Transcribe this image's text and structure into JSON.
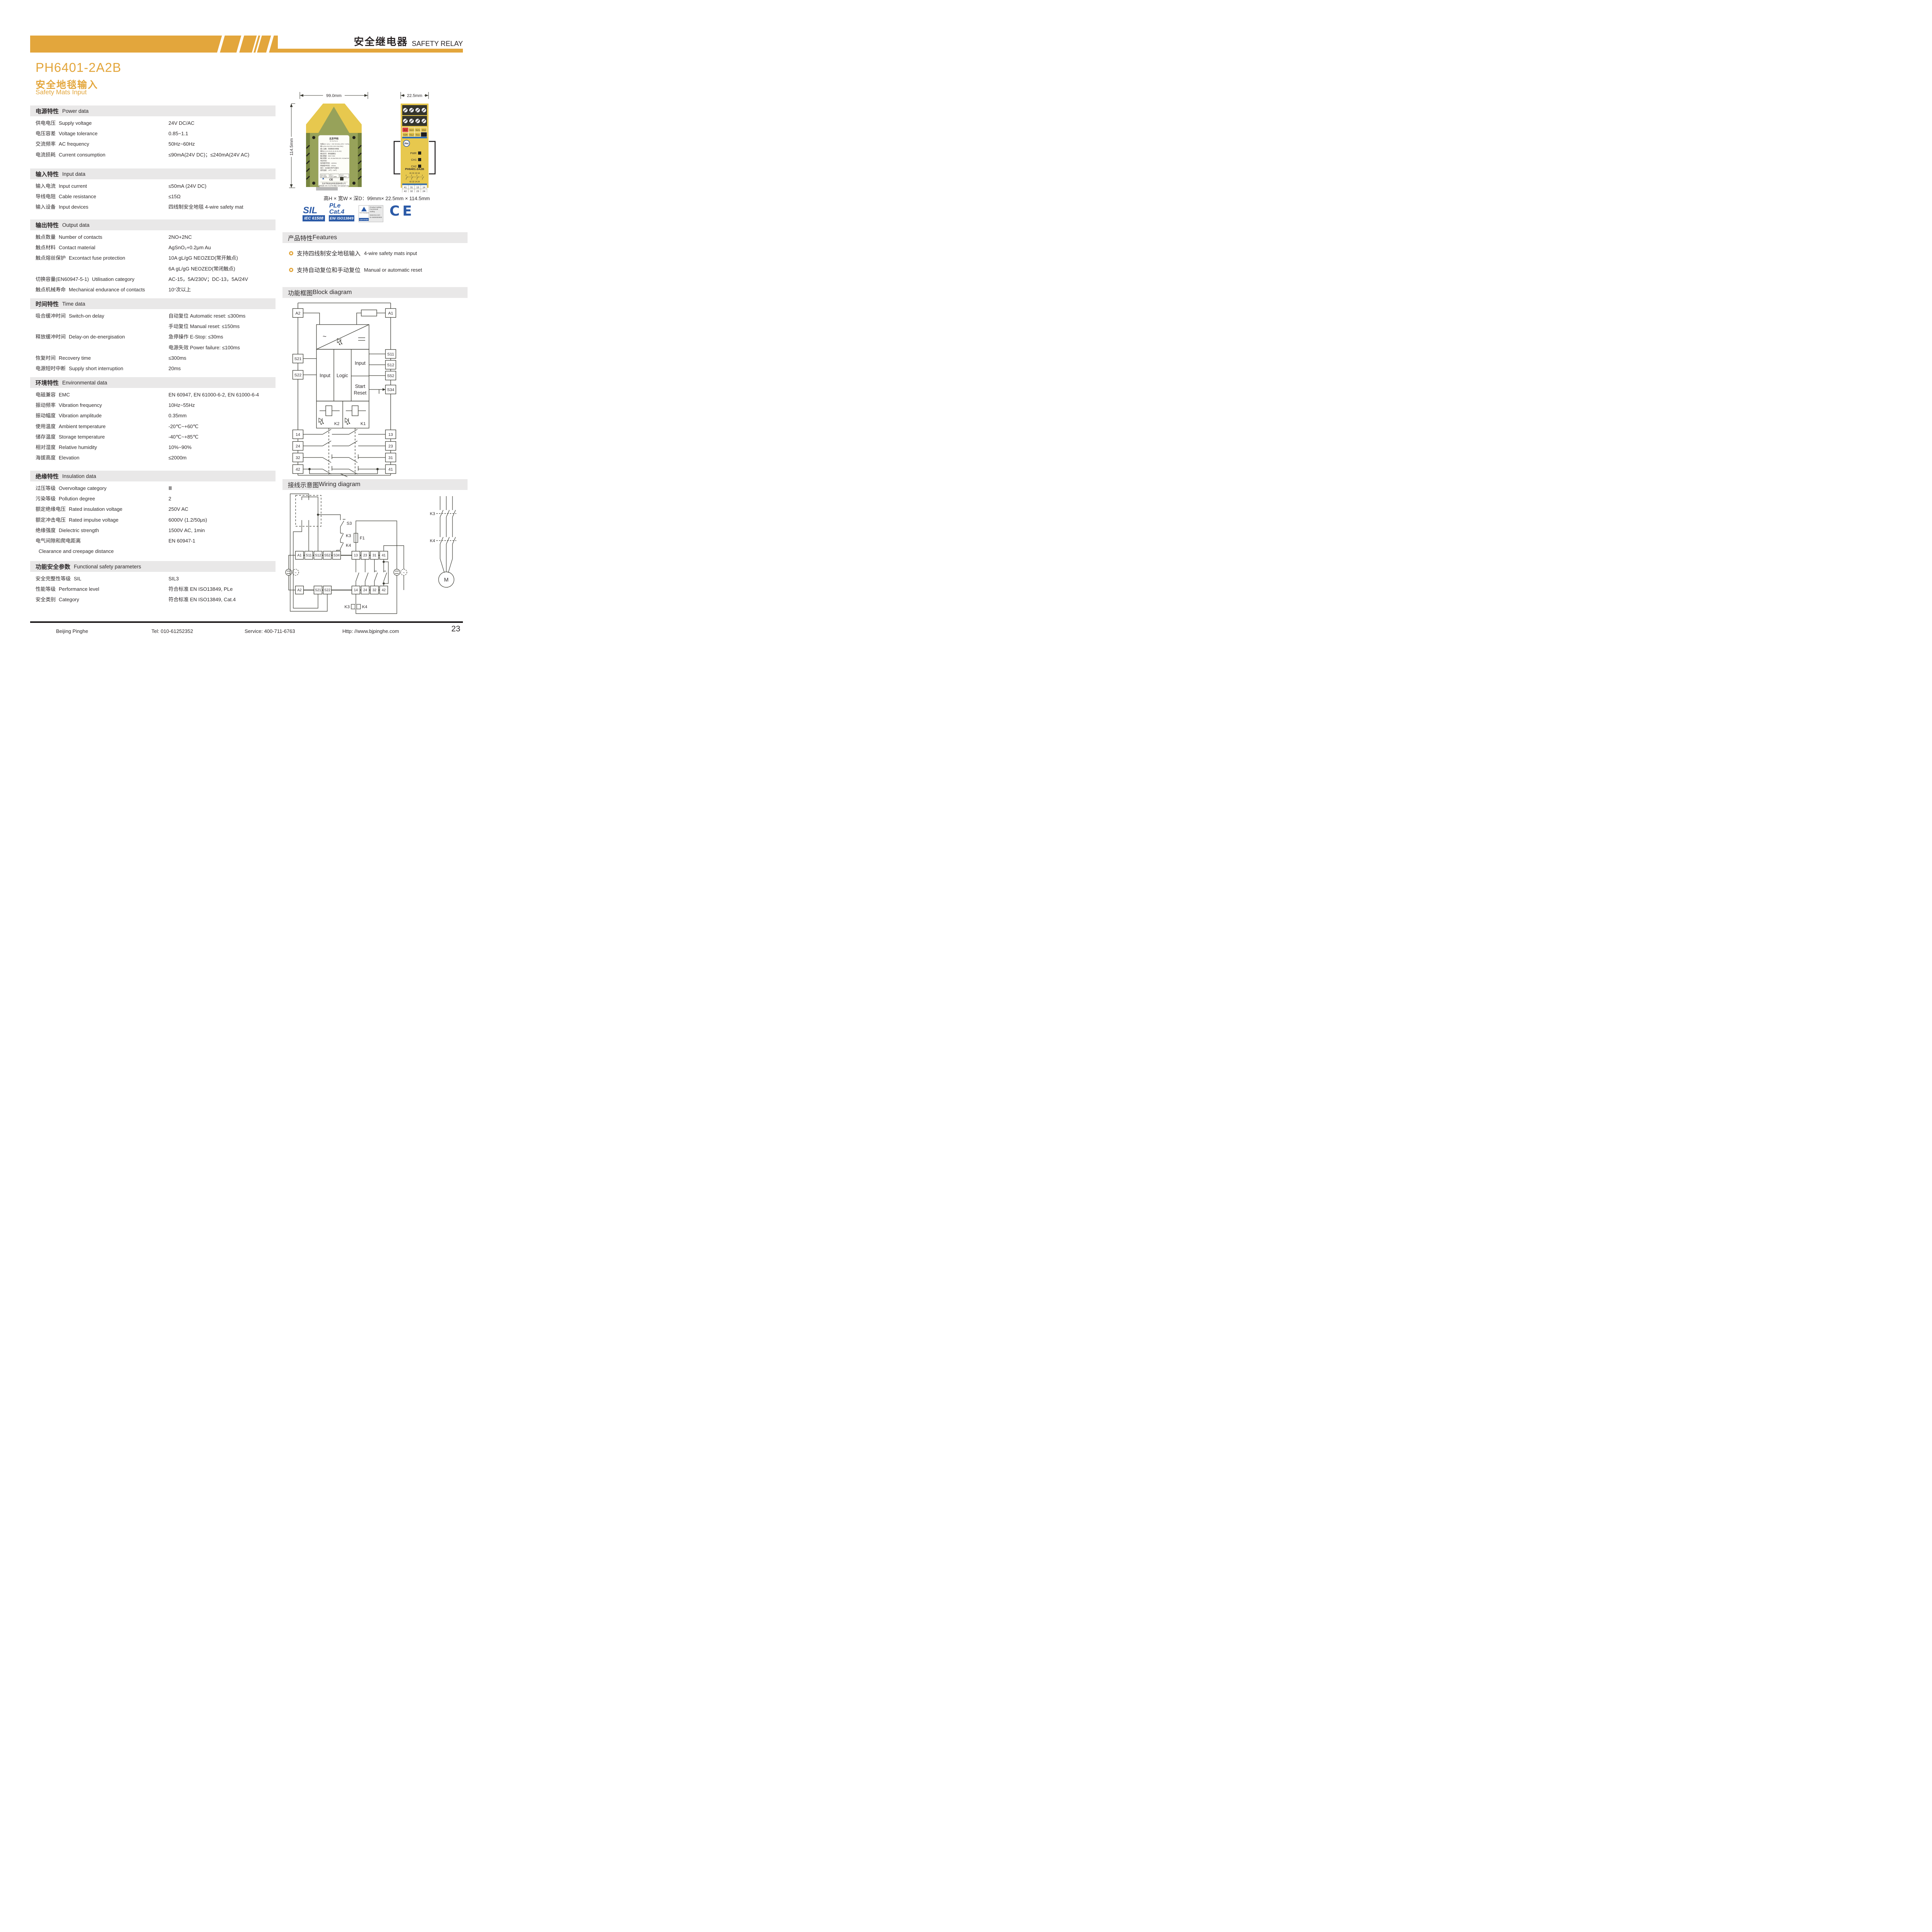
{
  "colors": {
    "accent": "#E3A63C",
    "band": "#E9E8E8",
    "blue": "#2B5AA7",
    "ink": "#2E2A2B",
    "device_yellow": "#E7C84E",
    "device_olive": "#97A25A",
    "red": "#D93A35"
  },
  "header": {
    "title_zh": "安全继电器",
    "title_en": "SAFETY RELAY"
  },
  "title": {
    "model": "PH6401-2A2B",
    "subtitle_zh": "安全地毯输入",
    "subtitle_en": "Safety Mats Input"
  },
  "sections": [
    {
      "id": "power",
      "zh": "电源特性",
      "en": "Power data",
      "rows": [
        {
          "zh": "供电电压",
          "en": "Supply voltage",
          "values": [
            "24V DC/AC"
          ]
        },
        {
          "zh": "电压容差",
          "en": "Voltage tolerance",
          "values": [
            "0.85~1.1"
          ]
        },
        {
          "zh": "交流频率",
          "en": "AC frequency",
          "values": [
            "50Hz~60Hz"
          ]
        },
        {
          "zh": "电流损耗",
          "en": "Current consumption",
          "values": [
            "≤90mA(24V DC)；≤240mA(24V AC)"
          ]
        }
      ]
    },
    {
      "id": "input",
      "zh": "输入特性",
      "en": "Input data",
      "rows": [
        {
          "zh": "输入电流",
          "en": "Input current",
          "values": [
            "≤50mA (24V DC)"
          ]
        },
        {
          "zh": "导线电阻",
          "en": "Cable resistance",
          "values": [
            "≤15Ω"
          ]
        },
        {
          "zh": "输入设备",
          "en": "Input devices",
          "values": [
            "四线制安全地毯  4-wire safety mat"
          ]
        }
      ]
    },
    {
      "id": "output",
      "zh": "输出特性",
      "en": "Output data",
      "rows": [
        {
          "zh": "触点数量",
          "en": "Number of contacts",
          "values": [
            "2NO+2NC"
          ]
        },
        {
          "zh": "触点材料",
          "en": "Contact material",
          "values": [
            "AgSnO₂+0.2μm Au"
          ]
        },
        {
          "zh": "触点熔丝保护",
          "en": "Excontact fuse protection",
          "values": [
            "10A gL/gG NEOZED(常开触点)",
            "6A gL/gG NEOZED(常闭触点)"
          ]
        },
        {
          "zh": "切换容量(EN60947-5-1)",
          "en": "Utilisation category",
          "values": [
            "AC-15，5A/230V；DC-13，5A/24V"
          ]
        },
        {
          "zh": "触点机械寿命",
          "en": "Mechanical endurance of contacts",
          "values": [
            "10⁷次以上"
          ]
        }
      ]
    },
    {
      "id": "time",
      "zh": "时间特性",
      "en": "Time data",
      "rows": [
        {
          "zh": "吸合缓冲时间",
          "en": "Switch-on delay",
          "values": [
            "自动复位  Automatic reset: ≤300ms",
            "手动复位  Manual reset: ≤150ms"
          ]
        },
        {
          "zh": "释放缓冲时间",
          "en": "Delay-on de-energisation",
          "values": [
            "急停操作  E-Stop: ≤30ms",
            "电源失效  Power failure: ≤100ms"
          ]
        },
        {
          "zh": "恢复时间",
          "en": "Recovery time",
          "values": [
            "≤300ms"
          ]
        },
        {
          "zh": "电源短时中断",
          "en": "Supply short interruption",
          "values": [
            "20ms"
          ]
        }
      ]
    },
    {
      "id": "environmental",
      "zh": "环境特性",
      "en": "Environmental data",
      "rows": [
        {
          "zh": "电磁兼容",
          "en": "EMC",
          "values": [
            "EN 60947, EN 61000-6-2, EN 61000-6-4"
          ]
        },
        {
          "zh": "振动频率",
          "en": "Vibration frequency",
          "values": [
            "10Hz~55Hz"
          ]
        },
        {
          "zh": "振动幅度",
          "en": "Vibration amplitude",
          "values": [
            "0.35mm"
          ]
        },
        {
          "zh": "使用温度",
          "en": "Ambient temperature",
          "values": [
            "-20℃~+60℃"
          ]
        },
        {
          "zh": "储存温度",
          "en": "Storage temperature",
          "values": [
            "-40℃~+85℃"
          ]
        },
        {
          "zh": "相对湿度",
          "en": "Relative humidity",
          "values": [
            "10%~90%"
          ]
        },
        {
          "zh": "海拔高度",
          "en": "Elevation",
          "values": [
            "≤2000m"
          ]
        }
      ]
    },
    {
      "id": "insulation",
      "zh": "绝缘特性",
      "en": "Insulation data",
      "rows": [
        {
          "zh": "过压等级",
          "en": "Overvoltage category",
          "values": [
            "Ⅲ"
          ]
        },
        {
          "zh": "污染等级",
          "en": "Pollution degree",
          "values": [
            "2"
          ]
        },
        {
          "zh": "额定绝缘电压",
          "en": "Rated insulation voltage",
          "values": [
            "250V AC"
          ]
        },
        {
          "zh": "额定冲击电压",
          "en": "Rated impulse voltage",
          "values": [
            "6000V (1.2/50μs)"
          ]
        },
        {
          "zh": "绝缘强度",
          "en": "Dielectric strength",
          "values": [
            "1500V AC, 1min"
          ]
        },
        {
          "zh": "电气间隙和爬电距离",
          "en": "Clearance and creepage distance",
          "stack": true,
          "values": [
            "EN 60947-1"
          ]
        }
      ]
    },
    {
      "id": "safety",
      "zh": "功能安全参数",
      "en": "Functional safety parameters",
      "rows": [
        {
          "zh": "安全完整性等级",
          "en": "SIL",
          "values": [
            "SIL3"
          ]
        },
        {
          "zh": "性能等级",
          "en": "Performance level",
          "values": [
            "符合标准  EN ISO13849, PLe"
          ]
        },
        {
          "zh": "安全类别",
          "en": "Category",
          "values": [
            "符合标准  EN ISO13849, Cat.4"
          ]
        }
      ]
    }
  ],
  "dimensions": {
    "width_label": "99.0mm",
    "depth_label": "22.5mm",
    "height_label": "114.5mm",
    "summary": "高H × 宽W × 深D：99mm× 22.5mm × 114.5mm"
  },
  "badges": {
    "sil": {
      "big": "SIL",
      "box": "IEC 61508"
    },
    "ple": {
      "line1": "PLe",
      "line2": "Cat.4",
      "box": "EN/ ISO13849"
    },
    "tuv": {
      "brand": "TÜV Rheinland",
      "certified": "CERTIFIED",
      "line1": "Product Safety",
      "line2": "Functional",
      "line3": "Safety",
      "url": "www.tuv.com",
      "id": "ID 0600000000"
    },
    "ce": "CE"
  },
  "features": {
    "zh": "产品特性",
    "en": "Features",
    "items": [
      {
        "zh": "支持四线制安全地毯输入",
        "en": "4-wire safety mats input"
      },
      {
        "zh": "支持自动复位和手动复位",
        "en": "Manual or automatic reset"
      }
    ]
  },
  "block_diagram": {
    "zh": "功能框图",
    "en": "Block diagram",
    "left": [
      "A2",
      "S21",
      "S22",
      "14",
      "24",
      "32",
      "42"
    ],
    "right": [
      "A1",
      "S11",
      "S12",
      "S52",
      "S34",
      "13",
      "23",
      "31",
      "41"
    ],
    "blocks": {
      "input_left": "Input",
      "logic": "Logic",
      "input_right": "Input",
      "start": "Start",
      "reset": "Reset",
      "k2": "K2",
      "k1": "K1"
    }
  },
  "wiring": {
    "zh": "接线示意图",
    "en": "Wiring diagram",
    "top": [
      "A1",
      "S11",
      "S12",
      "S52",
      "S34",
      "13",
      "23",
      "31",
      "41"
    ],
    "bottom": [
      "A2",
      "S21",
      "S22",
      "14",
      "24",
      "32",
      "42"
    ],
    "labels": {
      "s3": "S3",
      "k3": "K3",
      "k4": "K4",
      "f1": "F1",
      "coil_k3": "K3",
      "coil_k4": "K4",
      "motor": "M",
      "phase_k3": "K3",
      "phase_k4": "K4"
    }
  },
  "product": {
    "front": {
      "cells_top": [
        "A1",
        "S22",
        "S21",
        "S52"
      ],
      "cells_mid": [
        "S34",
        "S12",
        "S11",
        "A2"
      ],
      "leds": [
        "PWR",
        "CH1",
        "CH2"
      ],
      "model": "PH6401-2A2B",
      "mini_top": "41  31  13  14",
      "mini_bottom": "42  32  14  24",
      "out_top": [
        "41",
        "31",
        "13",
        "14"
      ],
      "out_bottom": [
        "42",
        "32",
        "23",
        "24"
      ]
    },
    "side_label": {
      "logo_zh": "北京平和",
      "logo_en": "Bei Jing Ping He",
      "lines": [
        "电源(A1+,A2-)：24V DC/AC(-15%~+10%)",
        "输入(S11,S12,S21,S22,S34,S52)：",
        "输入设备：四线制安全地毯",
        "输出(13,14,23,24,31,32,41,42)：",
        "输出信号：继电器输出",
        "触点数量：2NO+2NC",
        "触点容量：AC-15,5A/230V;DC-13,5A/24V",
        "响应时间：",
        "吸合缓冲时间：≤300ms",
        "释放缓冲时间：≤30ms",
        "复位：自动复位和手动复位",
        "使用温度：-20℃~+60℃"
      ],
      "certs": [
        "SIL3  SC3|IEC  61508",
        "PL  e|ISO  13849",
        "Cat  4|ISO  13849"
      ],
      "company": "北京平和创业科技发展有限公司",
      "support": "技术支持: 400-711-6763   网址: www.bjpinghe.com"
    }
  },
  "footer": {
    "company": "Beijing Pinghe",
    "tel": "Tel: 010-61252352",
    "service": "Service: 400-711-6763",
    "url": "Http: //www.bjpinghe.com",
    "page": "23"
  }
}
